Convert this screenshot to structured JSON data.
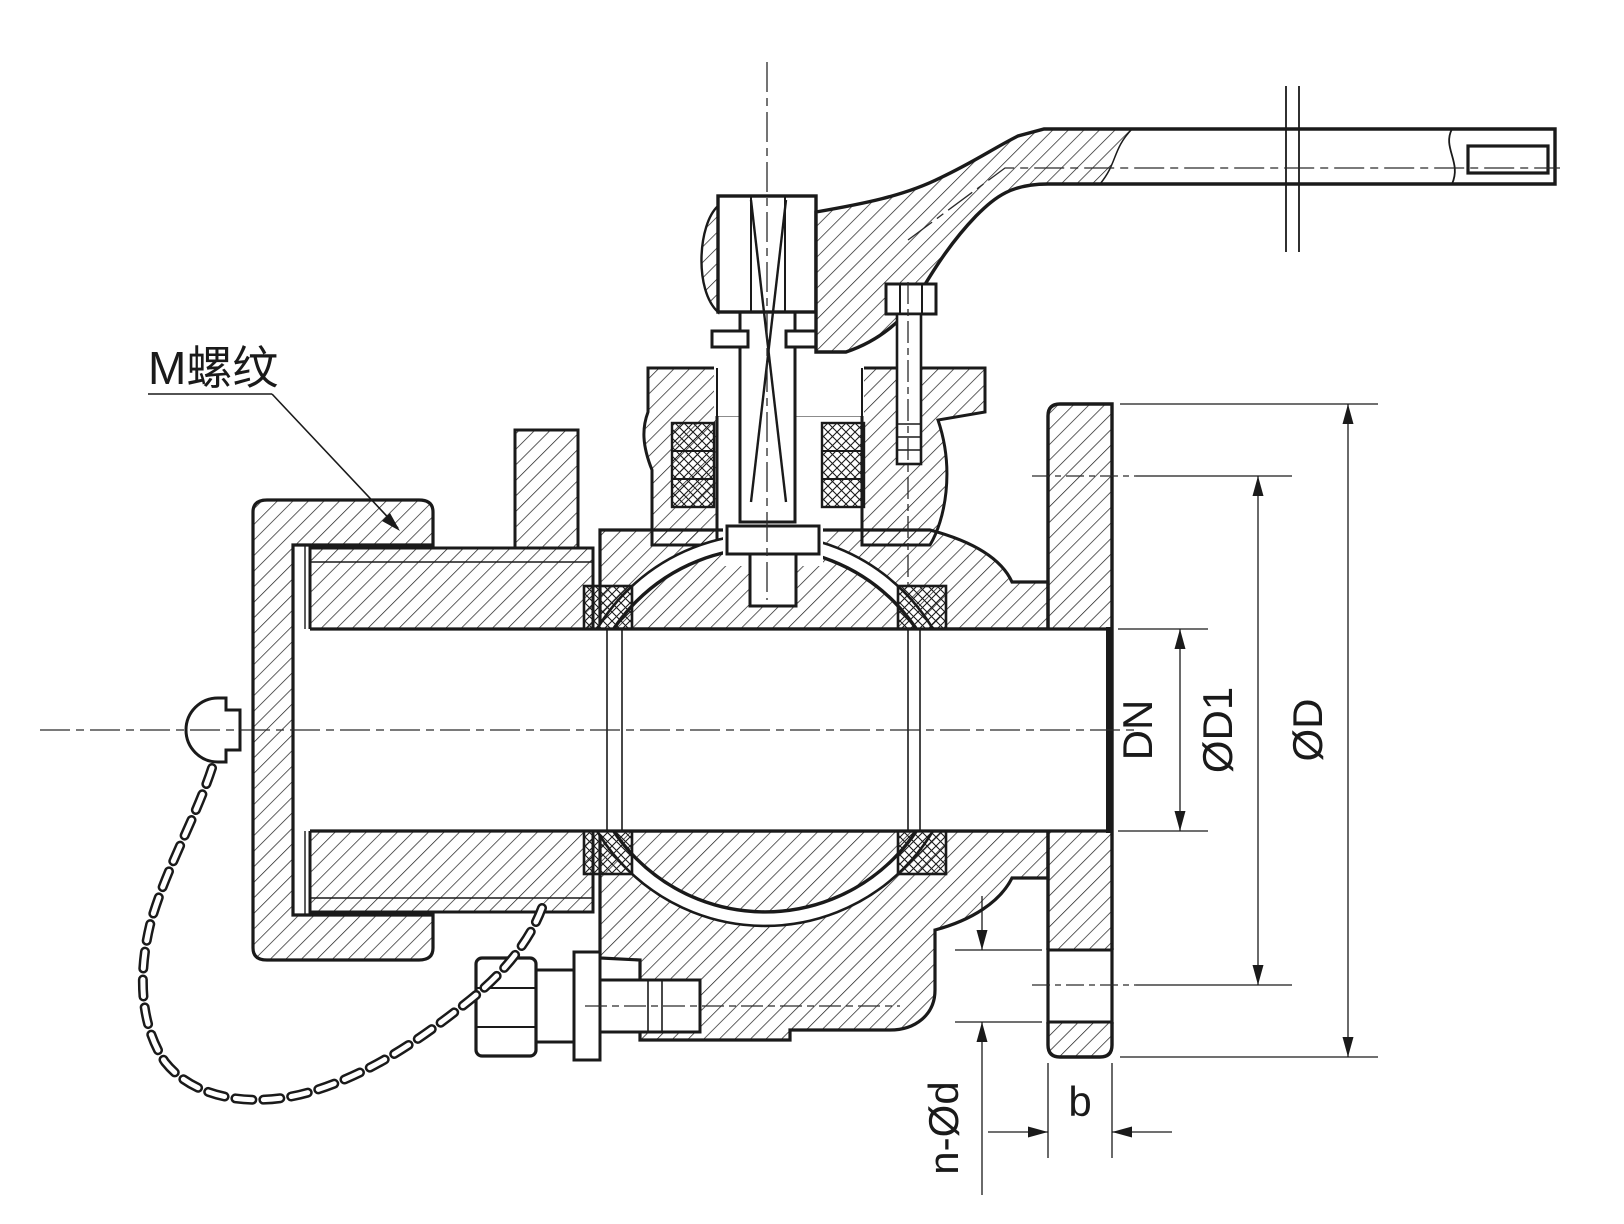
{
  "drawing": {
    "kind": "ball-valve-cross-section",
    "thread_note": "M螺纹",
    "dims": {
      "bore": "DN",
      "bolt_circle": "ØD1",
      "flange_od": "ØD",
      "bolt_holes": "n-Ød",
      "flange_thickness": "b"
    },
    "colors": {
      "line": "#1a1a1a",
      "background": "#ffffff"
    }
  }
}
